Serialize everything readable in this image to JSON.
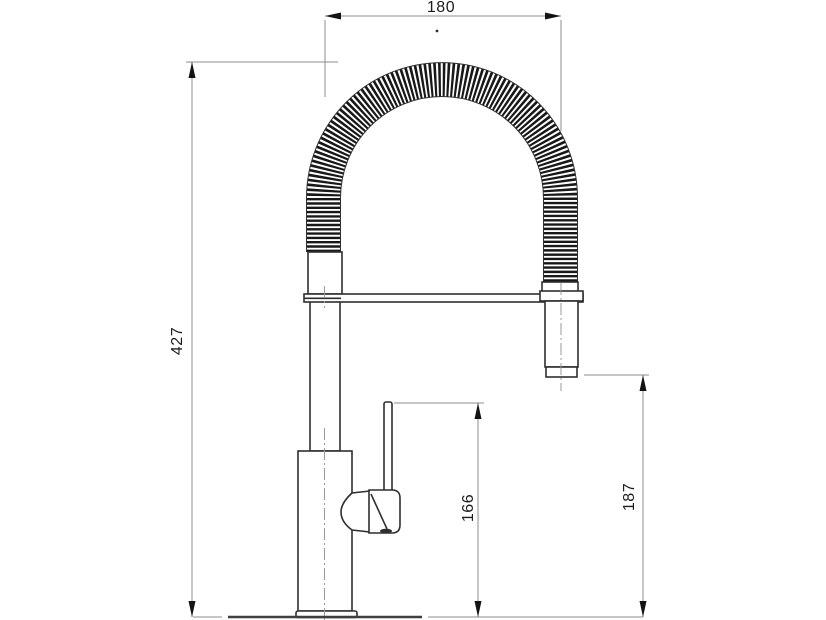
{
  "canvas": {
    "width": 826,
    "height": 620,
    "background": "#ffffff"
  },
  "colors": {
    "object_line": "#2f2f2f",
    "dimension_line": "#8c8c8c",
    "centerline": "#9a9a9a",
    "arrow": "#141414",
    "coil": "#181818",
    "text": "#1c1c1c",
    "ground_line": "#3f3f3f"
  },
  "dimensions": {
    "top_width": {
      "label": "180"
    },
    "total_height": {
      "label": "427"
    },
    "handle_height": {
      "label": "166"
    },
    "spout_height": {
      "label": "187"
    }
  }
}
